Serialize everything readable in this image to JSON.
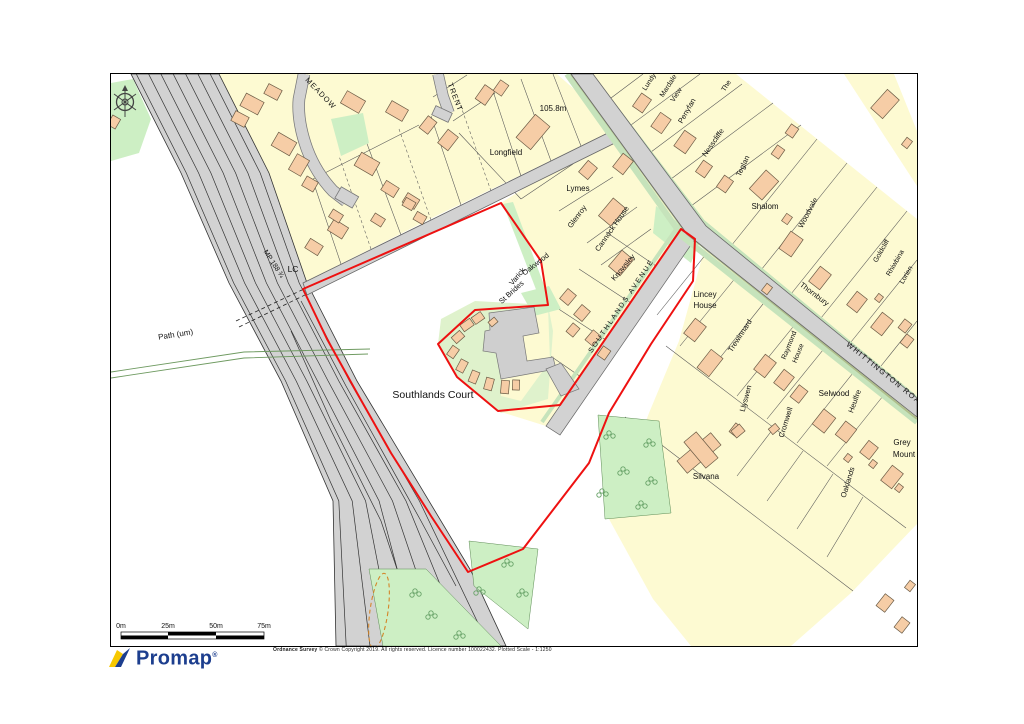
{
  "palette": {
    "plot_fill": "#FDFAD2",
    "building_fill": "#F6CDA6",
    "road_fill": "#D2D2D2",
    "green_fill": "#CDEFC4",
    "verge": "#C6E3BB",
    "boundary_red": "#EE1111",
    "promap_blue": "#1C3E8E",
    "promap_yellow": "#F7C800"
  },
  "map": {
    "labels": [
      {
        "t": "MEADOW",
        "x": 318,
        "y": 94,
        "r": 46,
        "s": 7.5,
        "ls": 1
      },
      {
        "t": "TRENT",
        "x": 452,
        "y": 97,
        "r": 69,
        "s": 7.5,
        "ls": 1
      },
      {
        "t": "105.8m",
        "x": 552,
        "y": 110,
        "r": 0,
        "s": 8,
        "ls": 0
      },
      {
        "t": "Longfield",
        "x": 505,
        "y": 154,
        "r": 0,
        "s": 8,
        "ls": 0
      },
      {
        "t": "Lymes",
        "x": 577,
        "y": 190,
        "r": 0,
        "s": 8,
        "ls": 0
      },
      {
        "t": "Glenroy",
        "x": 578,
        "y": 217,
        "r": -53,
        "s": 7.5,
        "ls": 0
      },
      {
        "t": "Cannock House",
        "x": 613,
        "y": 229,
        "r": -55,
        "s": 7.5,
        "ls": 0
      },
      {
        "t": "Knowsley",
        "x": 624,
        "y": 268,
        "r": -50,
        "s": 7.5,
        "ls": 0
      },
      {
        "t": "Oakwood",
        "x": 536,
        "y": 265,
        "r": -38,
        "s": 7.5,
        "ls": 0
      },
      {
        "t": "Varick",
        "x": 518,
        "y": 277,
        "r": -50,
        "s": 7.5,
        "ls": 0
      },
      {
        "t": "St Brides",
        "x": 512,
        "y": 293,
        "r": -42,
        "s": 7.5,
        "ls": 0
      },
      {
        "t": "SOUTHLANDS AVENUE",
        "x": 622,
        "y": 306,
        "r": -56,
        "s": 7,
        "ls": 2
      },
      {
        "t": "Lincey",
        "x": 704,
        "y": 296,
        "r": 0,
        "s": 8,
        "ls": 0
      },
      {
        "t": "House",
        "x": 704,
        "y": 307,
        "r": 0,
        "s": 8,
        "ls": 0
      },
      {
        "t": "Trewinnard",
        "x": 741,
        "y": 336,
        "r": -57,
        "s": 7.5,
        "ls": 0
      },
      {
        "t": "Thornbury",
        "x": 812,
        "y": 295,
        "r": 37,
        "s": 7.5,
        "ls": 0
      },
      {
        "t": "WHITTINGTON ROAD",
        "x": 884,
        "y": 376,
        "r": 39,
        "s": 7.5,
        "ls": 1.5
      },
      {
        "t": "Woodvale",
        "x": 809,
        "y": 213,
        "r": -62,
        "s": 7.5,
        "ls": 0
      },
      {
        "t": "Goldcliff",
        "x": 882,
        "y": 251,
        "r": -60,
        "s": 7,
        "ls": 0
      },
      {
        "t": "Rhiwbina",
        "x": 896,
        "y": 263,
        "r": -60,
        "s": 7,
        "ls": 0
      },
      {
        "t": "Lorien",
        "x": 907,
        "y": 275,
        "r": -60,
        "s": 7,
        "ls": 0
      },
      {
        "t": "Shalom",
        "x": 764,
        "y": 208,
        "r": 0,
        "s": 8,
        "ls": 0
      },
      {
        "t": "Teglan",
        "x": 744,
        "y": 166,
        "r": -65,
        "s": 7.5,
        "ls": 0
      },
      {
        "t": "Nesscliffe",
        "x": 714,
        "y": 143,
        "r": -55,
        "s": 7.5,
        "ls": 0
      },
      {
        "t": "Penyfan",
        "x": 688,
        "y": 111,
        "r": -60,
        "s": 7.5,
        "ls": 0
      },
      {
        "t": "Mardale",
        "x": 669,
        "y": 86,
        "r": -57,
        "s": 7,
        "ls": 0
      },
      {
        "t": "View",
        "x": 677,
        "y": 95,
        "r": -57,
        "s": 7,
        "ls": 0
      },
      {
        "t": "Lundy",
        "x": 650,
        "y": 82,
        "r": -57,
        "s": 7,
        "ls": 0
      },
      {
        "t": "The",
        "x": 727,
        "y": 86,
        "r": -57,
        "s": 7,
        "ls": 0
      },
      {
        "t": "LC",
        "x": 292,
        "y": 271,
        "r": 0,
        "s": 8.5,
        "ls": 0
      },
      {
        "t": "MP 188 ¾",
        "x": 271,
        "y": 264,
        "r": 57,
        "s": 7,
        "ls": 0
      },
      {
        "t": "Path (um)",
        "x": 175,
        "y": 336,
        "r": -9,
        "s": 8,
        "ls": 0
      },
      {
        "t": "Southlands Court",
        "x": 432,
        "y": 397,
        "r": 0,
        "s": 10.5,
        "ls": 0
      },
      {
        "t": "Silvana",
        "x": 705,
        "y": 478,
        "r": 0,
        "s": 8,
        "ls": 0
      },
      {
        "t": "Selwood",
        "x": 833,
        "y": 395,
        "r": 0,
        "s": 8,
        "ls": 0
      },
      {
        "t": "Heulfre",
        "x": 856,
        "y": 401,
        "r": -70,
        "s": 7.5,
        "ls": 0
      },
      {
        "t": "Grey",
        "x": 901,
        "y": 444,
        "r": 0,
        "s": 8,
        "ls": 0
      },
      {
        "t": "Mount",
        "x": 903,
        "y": 456,
        "r": 0,
        "s": 8,
        "ls": 0
      },
      {
        "t": "Oaklands",
        "x": 849,
        "y": 482,
        "r": -73,
        "s": 7.5,
        "ls": 0
      },
      {
        "t": "Cromwell",
        "x": 787,
        "y": 422,
        "r": -73,
        "s": 7.5,
        "ls": 0
      },
      {
        "t": "Llyswen",
        "x": 747,
        "y": 398,
        "r": -75,
        "s": 7.5,
        "ls": 0
      },
      {
        "t": "Raymond",
        "x": 790,
        "y": 345,
        "r": -68,
        "s": 7,
        "ls": 0
      },
      {
        "t": "House",
        "x": 799,
        "y": 353,
        "r": -68,
        "s": 7,
        "ls": 0
      }
    ],
    "buildings": [
      {
        "x": 251,
        "y": 103,
        "w": 20,
        "h": 14,
        "r": 28
      },
      {
        "x": 272,
        "y": 91,
        "w": 15,
        "h": 11,
        "r": 28
      },
      {
        "x": 239,
        "y": 118,
        "w": 15,
        "h": 11,
        "r": 28
      },
      {
        "x": 283,
        "y": 143,
        "w": 21,
        "h": 15,
        "r": 30
      },
      {
        "x": 298,
        "y": 164,
        "w": 14,
        "h": 18,
        "r": 30
      },
      {
        "x": 309,
        "y": 183,
        "w": 13,
        "h": 11,
        "r": 30
      },
      {
        "x": 352,
        "y": 101,
        "w": 21,
        "h": 14,
        "r": 30
      },
      {
        "x": 396,
        "y": 110,
        "w": 19,
        "h": 13,
        "r": 30
      },
      {
        "x": 366,
        "y": 163,
        "w": 21,
        "h": 15,
        "r": 30
      },
      {
        "x": 389,
        "y": 188,
        "w": 15,
        "h": 11,
        "r": 32
      },
      {
        "x": 410,
        "y": 200,
        "w": 14,
        "h": 11,
        "r": 32
      },
      {
        "x": 337,
        "y": 228,
        "w": 17,
        "h": 13,
        "r": 32
      },
      {
        "x": 313,
        "y": 246,
        "w": 15,
        "h": 11,
        "r": 32
      },
      {
        "x": 335,
        "y": 215,
        "w": 12,
        "h": 9,
        "r": 32
      },
      {
        "x": 377,
        "y": 219,
        "w": 12,
        "h": 9,
        "r": 32
      },
      {
        "x": 484,
        "y": 94,
        "w": 17,
        "h": 12,
        "r": -55
      },
      {
        "x": 500,
        "y": 87,
        "w": 13,
        "h": 10,
        "r": -55
      },
      {
        "x": 427,
        "y": 124,
        "w": 15,
        "h": 11,
        "r": -52
      },
      {
        "x": 447,
        "y": 139,
        "w": 17,
        "h": 13,
        "r": -52
      },
      {
        "x": 532,
        "y": 131,
        "w": 30,
        "h": 19,
        "r": -50
      },
      {
        "x": 408,
        "y": 203,
        "w": 11,
        "h": 9,
        "r": 30
      },
      {
        "x": 419,
        "y": 217,
        "w": 11,
        "h": 9,
        "r": 30
      },
      {
        "x": 587,
        "y": 169,
        "w": 15,
        "h": 12,
        "r": -50
      },
      {
        "x": 611,
        "y": 211,
        "w": 23,
        "h": 16,
        "r": -50
      },
      {
        "x": 622,
        "y": 163,
        "w": 17,
        "h": 13,
        "r": -52
      },
      {
        "x": 620,
        "y": 262,
        "w": 21,
        "h": 15,
        "r": -50
      },
      {
        "x": 567,
        "y": 296,
        "w": 13,
        "h": 11,
        "r": -50
      },
      {
        "x": 581,
        "y": 312,
        "w": 13,
        "h": 11,
        "r": -50
      },
      {
        "x": 572,
        "y": 329,
        "w": 11,
        "h": 9,
        "r": -50
      },
      {
        "x": 592,
        "y": 337,
        "w": 13,
        "h": 10,
        "r": -50
      },
      {
        "x": 603,
        "y": 352,
        "w": 11,
        "h": 9,
        "r": -55
      },
      {
        "x": 466,
        "y": 324,
        "w": 12,
        "h": 8,
        "r": -35
      },
      {
        "x": 477,
        "y": 317,
        "w": 11,
        "h": 8,
        "r": -35
      },
      {
        "x": 457,
        "y": 336,
        "w": 11,
        "h": 8,
        "r": -42
      },
      {
        "x": 452,
        "y": 351,
        "w": 11,
        "h": 8,
        "r": -55
      },
      {
        "x": 461,
        "y": 365,
        "w": 12,
        "h": 8,
        "r": -62
      },
      {
        "x": 473,
        "y": 376,
        "w": 12,
        "h": 8,
        "r": -68
      },
      {
        "x": 488,
        "y": 383,
        "w": 12,
        "h": 8,
        "r": -75
      },
      {
        "x": 504,
        "y": 386,
        "w": 13,
        "h": 8,
        "r": -85
      },
      {
        "x": 492,
        "y": 321,
        "w": 8,
        "h": 6,
        "r": -40
      },
      {
        "x": 515,
        "y": 384,
        "w": 10,
        "h": 7,
        "r": -88
      },
      {
        "x": 641,
        "y": 102,
        "w": 16,
        "h": 12,
        "r": -55
      },
      {
        "x": 660,
        "y": 122,
        "w": 17,
        "h": 13,
        "r": -55
      },
      {
        "x": 684,
        "y": 141,
        "w": 19,
        "h": 14,
        "r": -55
      },
      {
        "x": 703,
        "y": 168,
        "w": 14,
        "h": 11,
        "r": -55
      },
      {
        "x": 724,
        "y": 183,
        "w": 14,
        "h": 11,
        "r": -55
      },
      {
        "x": 763,
        "y": 184,
        "w": 25,
        "h": 17,
        "r": -48
      },
      {
        "x": 777,
        "y": 151,
        "w": 11,
        "h": 9,
        "r": -55
      },
      {
        "x": 791,
        "y": 130,
        "w": 11,
        "h": 9,
        "r": -55
      },
      {
        "x": 884,
        "y": 103,
        "w": 25,
        "h": 16,
        "r": -48
      },
      {
        "x": 786,
        "y": 218,
        "w": 9,
        "h": 7,
        "r": -55
      },
      {
        "x": 790,
        "y": 243,
        "w": 21,
        "h": 15,
        "r": -55
      },
      {
        "x": 819,
        "y": 277,
        "w": 19,
        "h": 14,
        "r": -52
      },
      {
        "x": 856,
        "y": 301,
        "w": 17,
        "h": 13,
        "r": -52
      },
      {
        "x": 881,
        "y": 323,
        "w": 19,
        "h": 14,
        "r": -52
      },
      {
        "x": 878,
        "y": 297,
        "w": 7,
        "h": 6,
        "r": -52
      },
      {
        "x": 904,
        "y": 325,
        "w": 11,
        "h": 9,
        "r": -52
      },
      {
        "x": 906,
        "y": 340,
        "w": 11,
        "h": 9,
        "r": -52
      },
      {
        "x": 906,
        "y": 142,
        "w": 9,
        "h": 7,
        "r": -52
      },
      {
        "x": 694,
        "y": 329,
        "w": 19,
        "h": 14,
        "r": -52
      },
      {
        "x": 709,
        "y": 362,
        "w": 23,
        "h": 15,
        "r": -52
      },
      {
        "x": 764,
        "y": 365,
        "w": 19,
        "h": 14,
        "r": -52
      },
      {
        "x": 783,
        "y": 379,
        "w": 17,
        "h": 13,
        "r": -52
      },
      {
        "x": 798,
        "y": 393,
        "w": 15,
        "h": 11,
        "r": -52
      },
      {
        "x": 735,
        "y": 429,
        "w": 11,
        "h": 9,
        "r": -52
      },
      {
        "x": 766,
        "y": 288,
        "w": 9,
        "h": 7,
        "r": -52
      },
      {
        "x": 823,
        "y": 420,
        "w": 19,
        "h": 15,
        "r": -52
      },
      {
        "x": 845,
        "y": 431,
        "w": 17,
        "h": 14,
        "r": -52
      },
      {
        "x": 868,
        "y": 449,
        "w": 15,
        "h": 12,
        "r": -52
      },
      {
        "x": 891,
        "y": 476,
        "w": 19,
        "h": 14,
        "r": -52
      },
      {
        "x": 847,
        "y": 457,
        "w": 7,
        "h": 6,
        "r": -52
      },
      {
        "x": 872,
        "y": 463,
        "w": 7,
        "h": 6,
        "r": -52
      },
      {
        "x": 898,
        "y": 487,
        "w": 7,
        "h": 6,
        "r": -52
      },
      {
        "x": 884,
        "y": 602,
        "w": 15,
        "h": 11,
        "r": -52
      },
      {
        "x": 901,
        "y": 624,
        "w": 13,
        "h": 10,
        "r": -52
      },
      {
        "x": 909,
        "y": 585,
        "w": 9,
        "h": 7,
        "r": -52
      },
      {
        "x": 698,
        "y": 452,
        "w": 44,
        "h": 16,
        "r": -40
      },
      {
        "x": 700,
        "y": 449,
        "w": 16,
        "h": 34,
        "r": -40
      },
      {
        "x": 737,
        "y": 430,
        "w": 11,
        "h": 9,
        "r": -40
      },
      {
        "x": 773,
        "y": 428,
        "w": 9,
        "h": 7,
        "r": -40
      },
      {
        "x": 113,
        "y": 121,
        "w": 9,
        "h": 11,
        "r": 30
      }
    ],
    "trees": [
      [
        608,
        432
      ],
      [
        622,
        468
      ],
      [
        601,
        490
      ],
      [
        640,
        502
      ],
      [
        650,
        478
      ],
      [
        478,
        588
      ],
      [
        430,
        612
      ],
      [
        458,
        632
      ],
      [
        414,
        590
      ],
      [
        506,
        560
      ],
      [
        521,
        590
      ],
      [
        648,
        440
      ]
    ]
  },
  "footer": {
    "scale_ticks": [
      "0m",
      "25m",
      "50m",
      "75m"
    ],
    "logo_text": "Promap",
    "logo_reg": "®",
    "copyright_bold": "Ordnance Survey",
    "copyright_rest": "  © Crown Copyright 2019. All rights reserved. Licence number 100022432. Plotted Scale - 1:1250"
  }
}
